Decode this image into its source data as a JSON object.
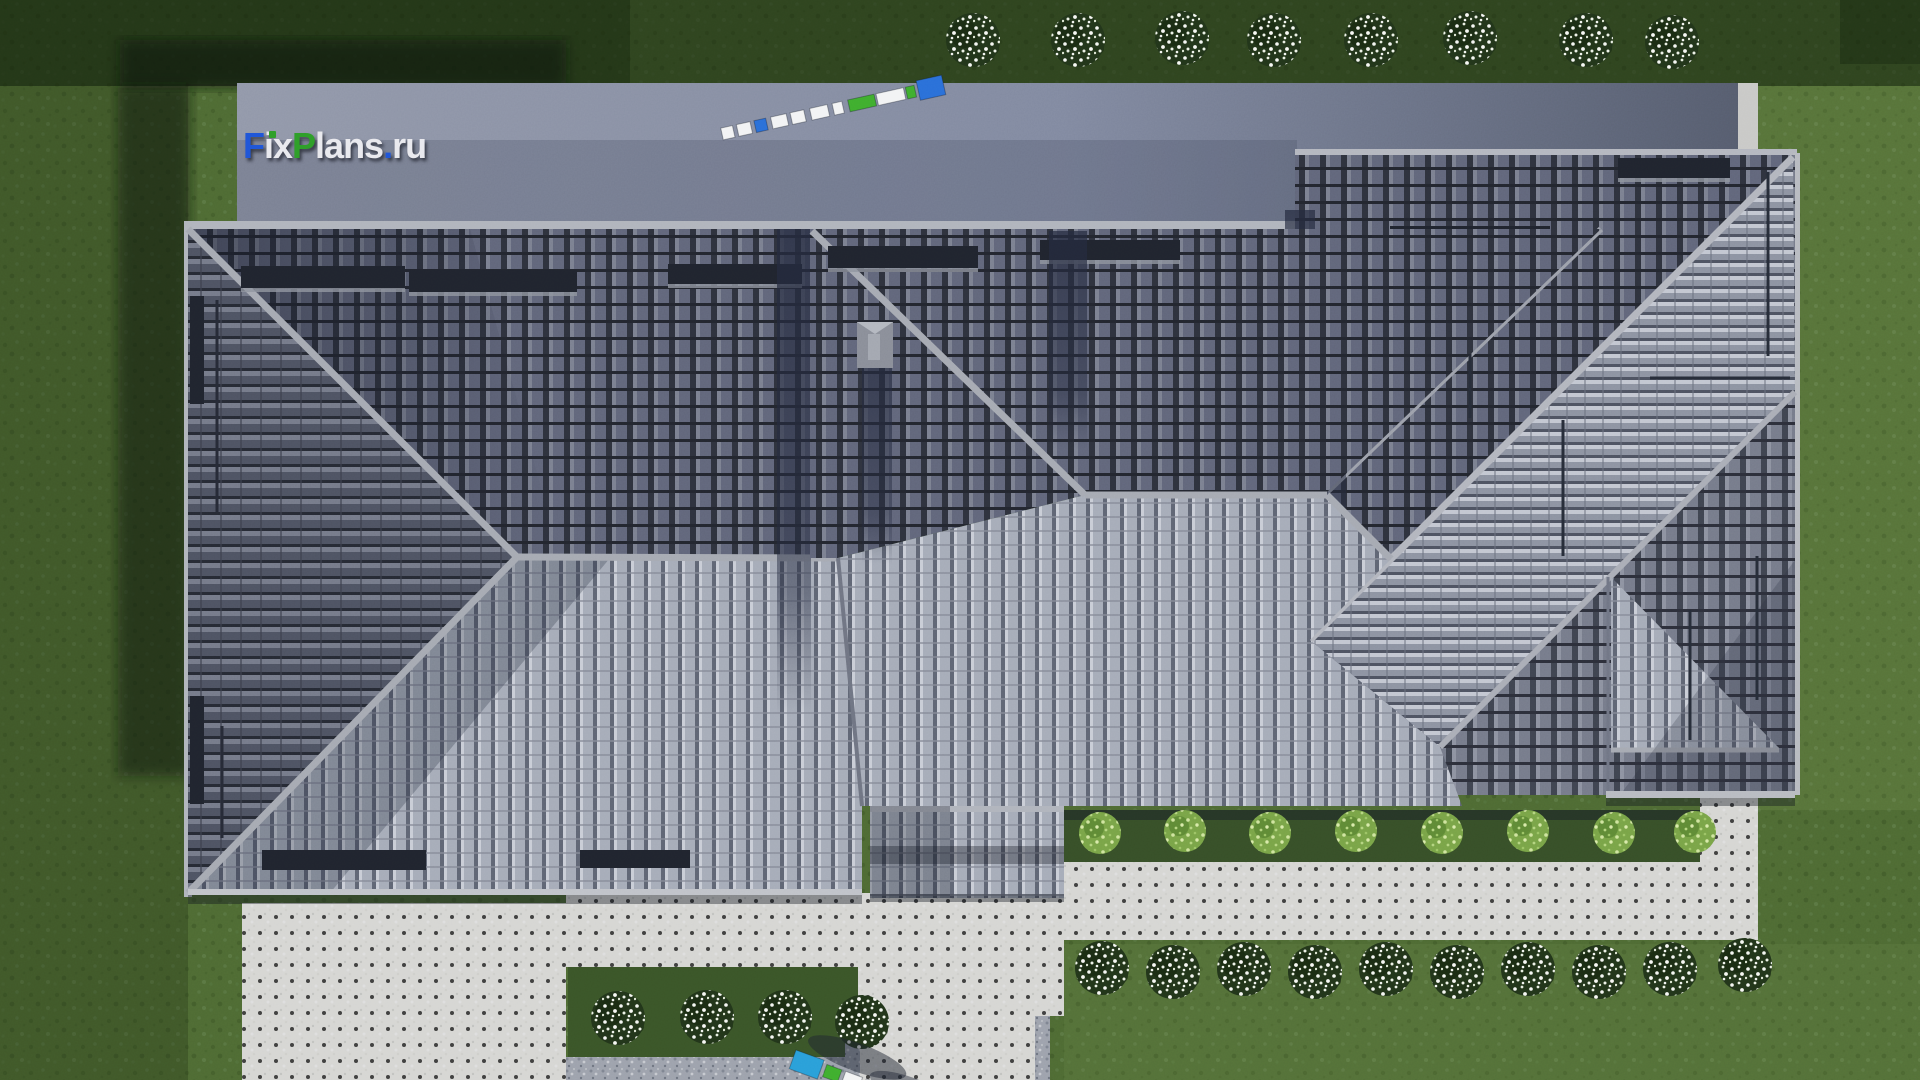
{
  "title": "FixPlans.ru — house roof, top-down 3D render",
  "logo": {
    "text": "FixPlans.ru",
    "parts": [
      {
        "t": "F",
        "c": "blue"
      },
      {
        "t": "ix",
        "c": "light"
      },
      {
        "t": "P",
        "c": "green"
      },
      {
        "t": "lans",
        "c": "light"
      },
      {
        "t": ".",
        "c": "blue"
      },
      {
        "t": "ru",
        "c": "light"
      }
    ],
    "colors": {
      "blue": "#2057d8",
      "green": "#2fa02a",
      "light": "#e9e9ee"
    }
  },
  "palette": {
    "grass": "#4e6a33",
    "grass_dark": "#2b4021",
    "grass_bed": "#3a5528",
    "concrete_apron": "#9298a9",
    "concrete_apron_dark": "#5b6174",
    "curb_strip": "#c9c9c7",
    "paving": "#d6d6d3",
    "gravel": "#9da2ac",
    "tile_dark": "#666b79",
    "tile_medium": "#767b8a",
    "tile_light": "#a6acb8",
    "ridge_trim": "#a6aab2",
    "roof_shadow": "#242a3e",
    "shrub_dark": "#22351a",
    "shrub_flowers": "#f4f6f2",
    "shrub_light": "#79a447",
    "ruler_blue": "#2a6fd8",
    "ruler_green": "#3fae2e",
    "ruler_white": "#f2f3f4"
  },
  "scene": {
    "type": "3D architectural render, top-down roof plan",
    "buildings": [
      {
        "name": "left wing",
        "roof": "hipped, dark concrete tiles, three ridge lines"
      },
      {
        "name": "central wing",
        "roof": "hipped, large sunlit south slope, chimney with long shadow"
      },
      {
        "name": "right wing",
        "roof": "hipped with diagonal valleys, bright ribbed band, tall chimney"
      }
    ],
    "vegetation": {
      "top_row_shrubs": 8,
      "rear_row_shrubs": 10,
      "flower_bed_shrubs": 4,
      "hedge_shrubs": 8
    },
    "hardscape": [
      "driveway apron along the top",
      "left patio slab",
      "back-door terrace",
      "T-shaped garden path with gravel edging",
      "rear walkway",
      "gravel strip"
    ],
    "markers": [
      "tilted measuring strip on driveway",
      "measuring strip at bottom edge"
    ]
  }
}
